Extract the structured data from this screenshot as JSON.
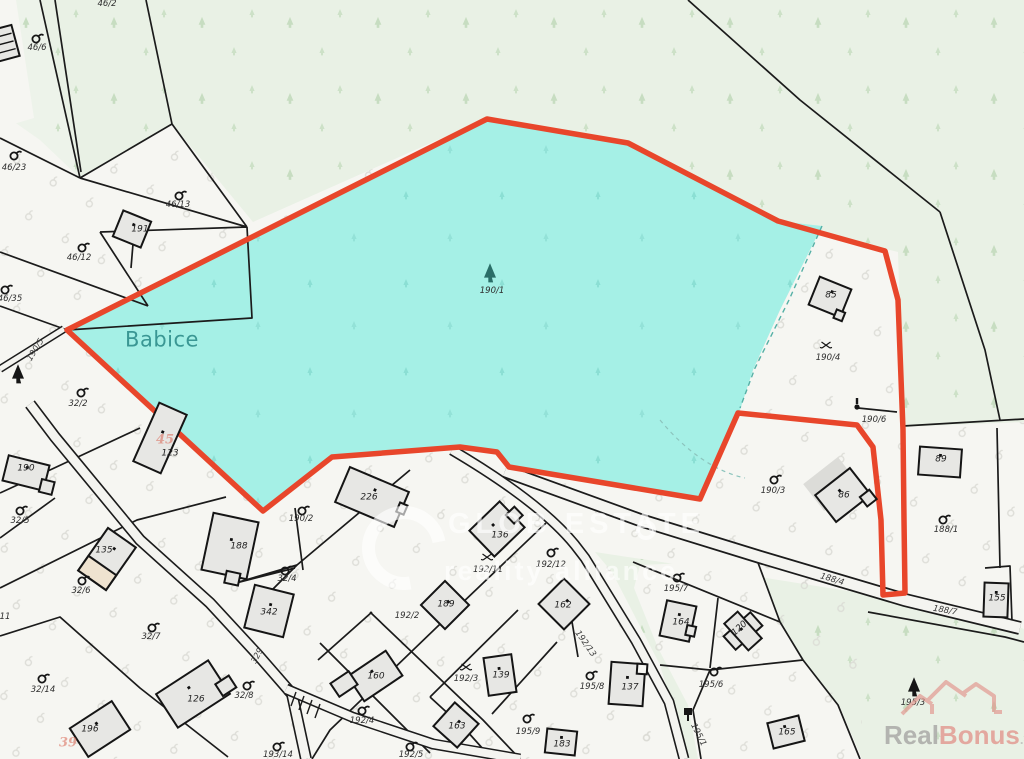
{
  "map": {
    "place": "Babice",
    "highlighted_parcel": "190/1",
    "colors": {
      "highlight_fill": "#a5f0e6",
      "highlight_outline": "#e8462b",
      "forest_tint": "#e9f1e5",
      "parcel_bg": "#f6f6f2",
      "place_text": "#3a9794",
      "house_number_red": "#d96452",
      "building_fill": "#e7e7e4"
    },
    "labels": [
      {
        "text": "46/2",
        "type": "parcel",
        "x": 107,
        "y": 4
      },
      {
        "text": "46/6",
        "type": "parcel",
        "x": 37,
        "y": 48
      },
      {
        "text": "46/23",
        "type": "parcel",
        "x": 14,
        "y": 168
      },
      {
        "text": "46/13",
        "type": "parcel",
        "x": 178,
        "y": 205
      },
      {
        "text": "46/12",
        "type": "parcel",
        "x": 79,
        "y": 258
      },
      {
        "text": "46/35",
        "type": "parcel",
        "x": 10,
        "y": 299
      },
      {
        "text": "191",
        "type": "building",
        "x": 140,
        "y": 230
      },
      {
        "text": "190/5",
        "type": "road",
        "x": 36,
        "y": 350,
        "rot": -58
      },
      {
        "text": "Babice",
        "type": "place",
        "x": 162,
        "y": 340
      },
      {
        "text": "190/1",
        "type": "parcel",
        "x": 492,
        "y": 291
      },
      {
        "text": "32/2",
        "type": "parcel",
        "x": 78,
        "y": 404
      },
      {
        "text": "190",
        "type": "building",
        "x": 26,
        "y": 469
      },
      {
        "text": "123",
        "type": "building",
        "x": 170,
        "y": 454
      },
      {
        "text": "45",
        "type": "red",
        "x": 165,
        "y": 440
      },
      {
        "text": "32/5",
        "type": "parcel",
        "x": 20,
        "y": 521
      },
      {
        "text": "135",
        "type": "building",
        "x": 104,
        "y": 551
      },
      {
        "text": "32/6",
        "type": "parcel",
        "x": 81,
        "y": 591
      },
      {
        "text": "188",
        "type": "building",
        "x": 239,
        "y": 547
      },
      {
        "text": "32/4",
        "type": "parcel",
        "x": 287,
        "y": 579
      },
      {
        "text": "342",
        "type": "building",
        "x": 269,
        "y": 613
      },
      {
        "text": "190/2",
        "type": "parcel",
        "x": 301,
        "y": 519
      },
      {
        "text": "32/7",
        "type": "parcel",
        "x": 151,
        "y": 637
      },
      {
        "text": "329",
        "type": "road",
        "x": 258,
        "y": 656,
        "rot": -62
      },
      {
        "text": "32/14",
        "type": "parcel",
        "x": 43,
        "y": 690
      },
      {
        "text": "126",
        "type": "building",
        "x": 196,
        "y": 700
      },
      {
        "text": "32/8",
        "type": "parcel",
        "x": 244,
        "y": 696
      },
      {
        "text": "196",
        "type": "building",
        "x": 90,
        "y": 730
      },
      {
        "text": "39",
        "type": "red",
        "x": 68,
        "y": 743
      },
      {
        "text": "193/14",
        "type": "parcel",
        "x": 278,
        "y": 755
      },
      {
        "text": "226",
        "type": "building",
        "x": 369,
        "y": 498
      },
      {
        "text": "136",
        "type": "building",
        "x": 500,
        "y": 536
      },
      {
        "text": "192/11",
        "type": "parcel",
        "x": 488,
        "y": 570
      },
      {
        "text": "192/12",
        "type": "parcel",
        "x": 551,
        "y": 565
      },
      {
        "text": "189",
        "type": "building",
        "x": 446,
        "y": 605
      },
      {
        "text": "162",
        "type": "building",
        "x": 563,
        "y": 606
      },
      {
        "text": "192/2",
        "type": "parcel",
        "x": 407,
        "y": 616
      },
      {
        "text": "192/13",
        "type": "road",
        "x": 585,
        "y": 644,
        "rot": 55
      },
      {
        "text": "192/3",
        "type": "parcel",
        "x": 466,
        "y": 679
      },
      {
        "text": "160",
        "type": "building",
        "x": 376,
        "y": 677
      },
      {
        "text": "139",
        "type": "building",
        "x": 501,
        "y": 676
      },
      {
        "text": "137",
        "type": "building",
        "x": 630,
        "y": 688
      },
      {
        "text": "192/4",
        "type": "parcel",
        "x": 362,
        "y": 721
      },
      {
        "text": "163",
        "type": "building",
        "x": 457,
        "y": 727
      },
      {
        "text": "192/5",
        "type": "parcel",
        "x": 411,
        "y": 755
      },
      {
        "text": "195/9",
        "type": "parcel",
        "x": 528,
        "y": 732
      },
      {
        "text": "183",
        "type": "building",
        "x": 562,
        "y": 745
      },
      {
        "text": "195/8",
        "type": "parcel",
        "x": 592,
        "y": 687
      },
      {
        "text": "195/7",
        "type": "parcel",
        "x": 676,
        "y": 589
      },
      {
        "text": "164",
        "type": "building",
        "x": 681,
        "y": 623
      },
      {
        "text": "120",
        "type": "building",
        "x": 740,
        "y": 629,
        "rot": -42
      },
      {
        "text": "195/6",
        "type": "parcel",
        "x": 711,
        "y": 685
      },
      {
        "text": "195/1",
        "type": "road",
        "x": 698,
        "y": 735,
        "rot": 63
      },
      {
        "text": "165",
        "type": "building",
        "x": 787,
        "y": 733
      },
      {
        "text": "85",
        "type": "building",
        "x": 831,
        "y": 296
      },
      {
        "text": "190/4",
        "type": "parcel",
        "x": 828,
        "y": 358
      },
      {
        "text": "190/6",
        "type": "parcel",
        "x": 874,
        "y": 420
      },
      {
        "text": "89",
        "type": "building",
        "x": 941,
        "y": 460
      },
      {
        "text": "190/3",
        "type": "parcel",
        "x": 773,
        "y": 491
      },
      {
        "text": "86",
        "type": "building",
        "x": 844,
        "y": 496
      },
      {
        "text": "188/1",
        "type": "parcel",
        "x": 946,
        "y": 530
      },
      {
        "text": "188/4",
        "type": "road",
        "x": 832,
        "y": 580,
        "rot": 17
      },
      {
        "text": "188/7",
        "type": "road",
        "x": 945,
        "y": 611,
        "rot": 10
      },
      {
        "text": "155",
        "type": "building",
        "x": 997,
        "y": 599
      },
      {
        "text": "195/3",
        "type": "parcel",
        "x": 913,
        "y": 703
      },
      {
        "text": "11",
        "type": "parcel",
        "x": 5,
        "y": 617
      }
    ]
  },
  "watermark": {
    "line1": "GLOB ESTATE",
    "line2": "reality alliance"
  },
  "logo": {
    "real": "Real",
    "bonus": "Bonus",
    "tld": ".cz"
  }
}
